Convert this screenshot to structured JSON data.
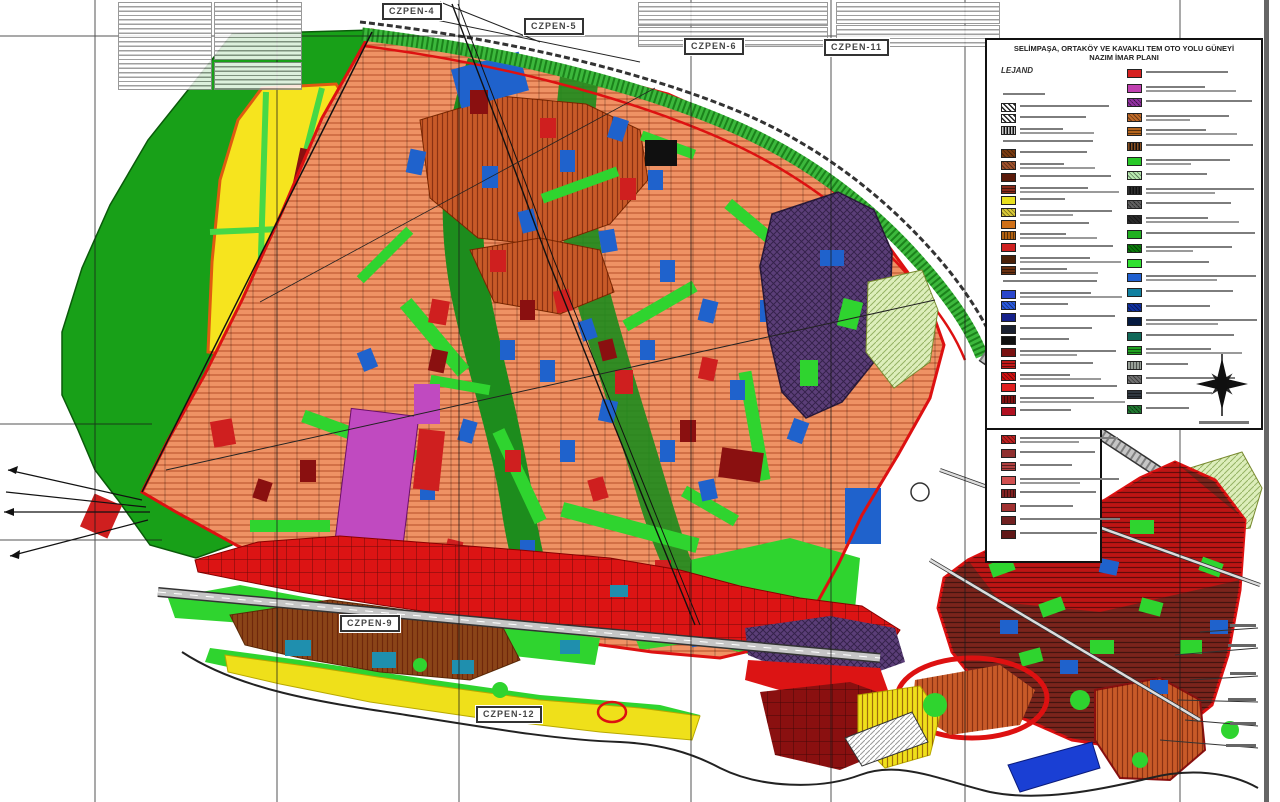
{
  "document": {
    "kind": "scanned municipal zoning master plan (nazım imar planı)",
    "title_line1": "SELİMPAŞA, ORTAKÖY VE KAVAKLI TEM OTO YOLU GÜNEYİ",
    "title_line2": "NAZIM İMAR PLANI"
  },
  "legend": {
    "heading": "LEJAND",
    "note": "legend entry labels are present in the scan but too small to read; rendered as placeholder text lines",
    "left_items": [
      {
        "swatch": null,
        "pattern": "text",
        "lines": 1
      },
      {
        "swatch": "#e8e8e8",
        "pattern": "bwdiag",
        "lines": 1
      },
      {
        "swatch": "#d8d8d8",
        "pattern": "bwdiag",
        "lines": 1
      },
      {
        "swatch": "#c8c8c8",
        "pattern": "bwdots",
        "lines": 2
      },
      {
        "swatch": null,
        "pattern": "text",
        "lines": 1
      },
      {
        "swatch": "#7a3b10",
        "pattern": "diag",
        "lines": 1
      },
      {
        "swatch": "#a0522d",
        "pattern": "diag",
        "lines": 2
      },
      {
        "swatch": "#5a1a0a",
        "pattern": "solid",
        "lines": 1
      },
      {
        "swatch": "#8a2a1a",
        "pattern": "hlines",
        "lines": 2
      },
      {
        "swatch": "#e8e020",
        "pattern": "solid",
        "lines": 1
      },
      {
        "swatch": "#d8c838",
        "pattern": "diag",
        "lines": 2
      },
      {
        "swatch": "#d07018",
        "pattern": "solid",
        "lines": 1
      },
      {
        "swatch": "#b06010",
        "pattern": "vlines",
        "lines": 2
      },
      {
        "swatch": "#cf2020",
        "pattern": "solid",
        "lines": 1
      },
      {
        "swatch": "#4a2008",
        "pattern": "solid",
        "lines": 2
      },
      {
        "swatch": "#6a3010",
        "pattern": "hlines",
        "lines": 2
      },
      {
        "swatch": null,
        "pattern": "text",
        "lines": 1
      },
      {
        "swatch": "#2a46cc",
        "pattern": "solid",
        "lines": 2
      },
      {
        "swatch": "#2a5adf",
        "pattern": "diag",
        "lines": 1
      },
      {
        "swatch": "#15208a",
        "pattern": "solid",
        "lines": 1
      },
      {
        "swatch": "#1a2030",
        "pattern": "solid",
        "lines": 1
      },
      {
        "swatch": "#101010",
        "pattern": "solid",
        "lines": 1
      },
      {
        "swatch": "#7a1212",
        "pattern": "solid",
        "lines": 2
      },
      {
        "swatch": "#c01818",
        "pattern": "hlines",
        "lines": 1
      },
      {
        "swatch": "#d01010",
        "pattern": "diag",
        "lines": 2
      },
      {
        "swatch": "#e02020",
        "pattern": "solid",
        "lines": 1
      },
      {
        "swatch": "#801010",
        "pattern": "vlines",
        "lines": 2
      },
      {
        "swatch": "#b01020",
        "pattern": "solid",
        "lines": 1
      },
      {
        "swatch": "#c02020",
        "pattern": "diag",
        "lines": 2
      },
      {
        "swatch": "#903030",
        "pattern": "solid",
        "lines": 1
      },
      {
        "swatch": "#b04040",
        "pattern": "hlines",
        "lines": 1
      },
      {
        "swatch": "#d05050",
        "pattern": "solid",
        "lines": 2
      },
      {
        "swatch": "#802020",
        "pattern": "vlines",
        "lines": 1
      },
      {
        "swatch": "#a03030",
        "pattern": "solid",
        "lines": 1
      },
      {
        "swatch": "#702020",
        "pattern": "solid",
        "lines": 1
      },
      {
        "swatch": "#601818",
        "pattern": "solid",
        "lines": 1
      }
    ],
    "right_items": [
      {
        "swatch": "#d62020",
        "pattern": "solid",
        "lines": 1
      },
      {
        "swatch": "#c040b0",
        "pattern": "solid",
        "lines": 2
      },
      {
        "swatch": "#9030a0",
        "pattern": "cross",
        "lines": 1
      },
      {
        "swatch": "#c06a28",
        "pattern": "diag",
        "lines": 2
      },
      {
        "swatch": "#b5651d",
        "pattern": "hlines",
        "lines": 2
      },
      {
        "swatch": "#8a5020",
        "pattern": "bwdots",
        "lines": 1
      },
      {
        "swatch": "#28c828",
        "pattern": "solid",
        "lines": 2
      },
      {
        "swatch": "#b8eab0",
        "pattern": "diag",
        "lines": 1
      },
      {
        "swatch": "#303030",
        "pattern": "bwdots",
        "lines": 2
      },
      {
        "swatch": "#606060",
        "pattern": "cross",
        "lines": 1
      },
      {
        "swatch": "#2a2a2a",
        "pattern": "diag",
        "lines": 2
      },
      {
        "swatch": "#20b020",
        "pattern": "solid",
        "lines": 1
      },
      {
        "swatch": "#0a7a0a",
        "pattern": "diag",
        "lines": 2
      },
      {
        "swatch": "#30e030",
        "pattern": "solid",
        "lines": 1
      },
      {
        "swatch": "#2060d0",
        "pattern": "solid",
        "lines": 2
      },
      {
        "swatch": "#1080a0",
        "pattern": "solid",
        "lines": 1
      },
      {
        "swatch": "#1030a0",
        "pattern": "diag",
        "lines": 1
      },
      {
        "swatch": "#051a40",
        "pattern": "solid",
        "lines": 2
      },
      {
        "swatch": "#106858",
        "pattern": "solid",
        "lines": 1
      },
      {
        "swatch": "#20a020",
        "pattern": "hlines",
        "lines": 2
      },
      {
        "swatch": "#98a098",
        "pattern": "vlines",
        "lines": 1
      },
      {
        "swatch": "#707070",
        "pattern": "diag",
        "lines": 1
      },
      {
        "swatch": "#303840",
        "pattern": "hlines",
        "lines": 1
      },
      {
        "swatch": "#207830",
        "pattern": "cross",
        "lines": 1
      }
    ]
  },
  "sheet_labels": [
    {
      "label": "CZPEN-4"
    },
    {
      "label": "CZPEN-5"
    },
    {
      "label": "CZPEN-6"
    },
    {
      "label": "CZPEN-11"
    },
    {
      "label": "CZPEN-9"
    },
    {
      "label": "CZPEN-12"
    }
  ],
  "compass": {
    "icon": "north-arrow-star"
  },
  "colors": {
    "forest": "#18a018",
    "agriculture_yellow": "#f6e41e",
    "residential_salmon": "#ef9264",
    "dense_orange": "#c85a28",
    "park_green": "#2fd42f",
    "river_green": "#1d8c1d",
    "commercial_red": "#dc1414",
    "military_purple": "#5b3e78",
    "east_maroon": "#7a241c",
    "east_red": "#c41414",
    "pale_green": "#ddeebb",
    "coast_yellow": "#efe01a",
    "brown": "#8a4418",
    "teal": "#1f8fae",
    "parcel_blue": "#1f62cc",
    "parcel_red": "#cf1f1f",
    "parcel_darkred": "#8a1010",
    "magenta": "#c04ac0",
    "boundary_red": "#dd1111",
    "road_grey": "#c6c6c6",
    "band_green": "#3cb83c"
  }
}
